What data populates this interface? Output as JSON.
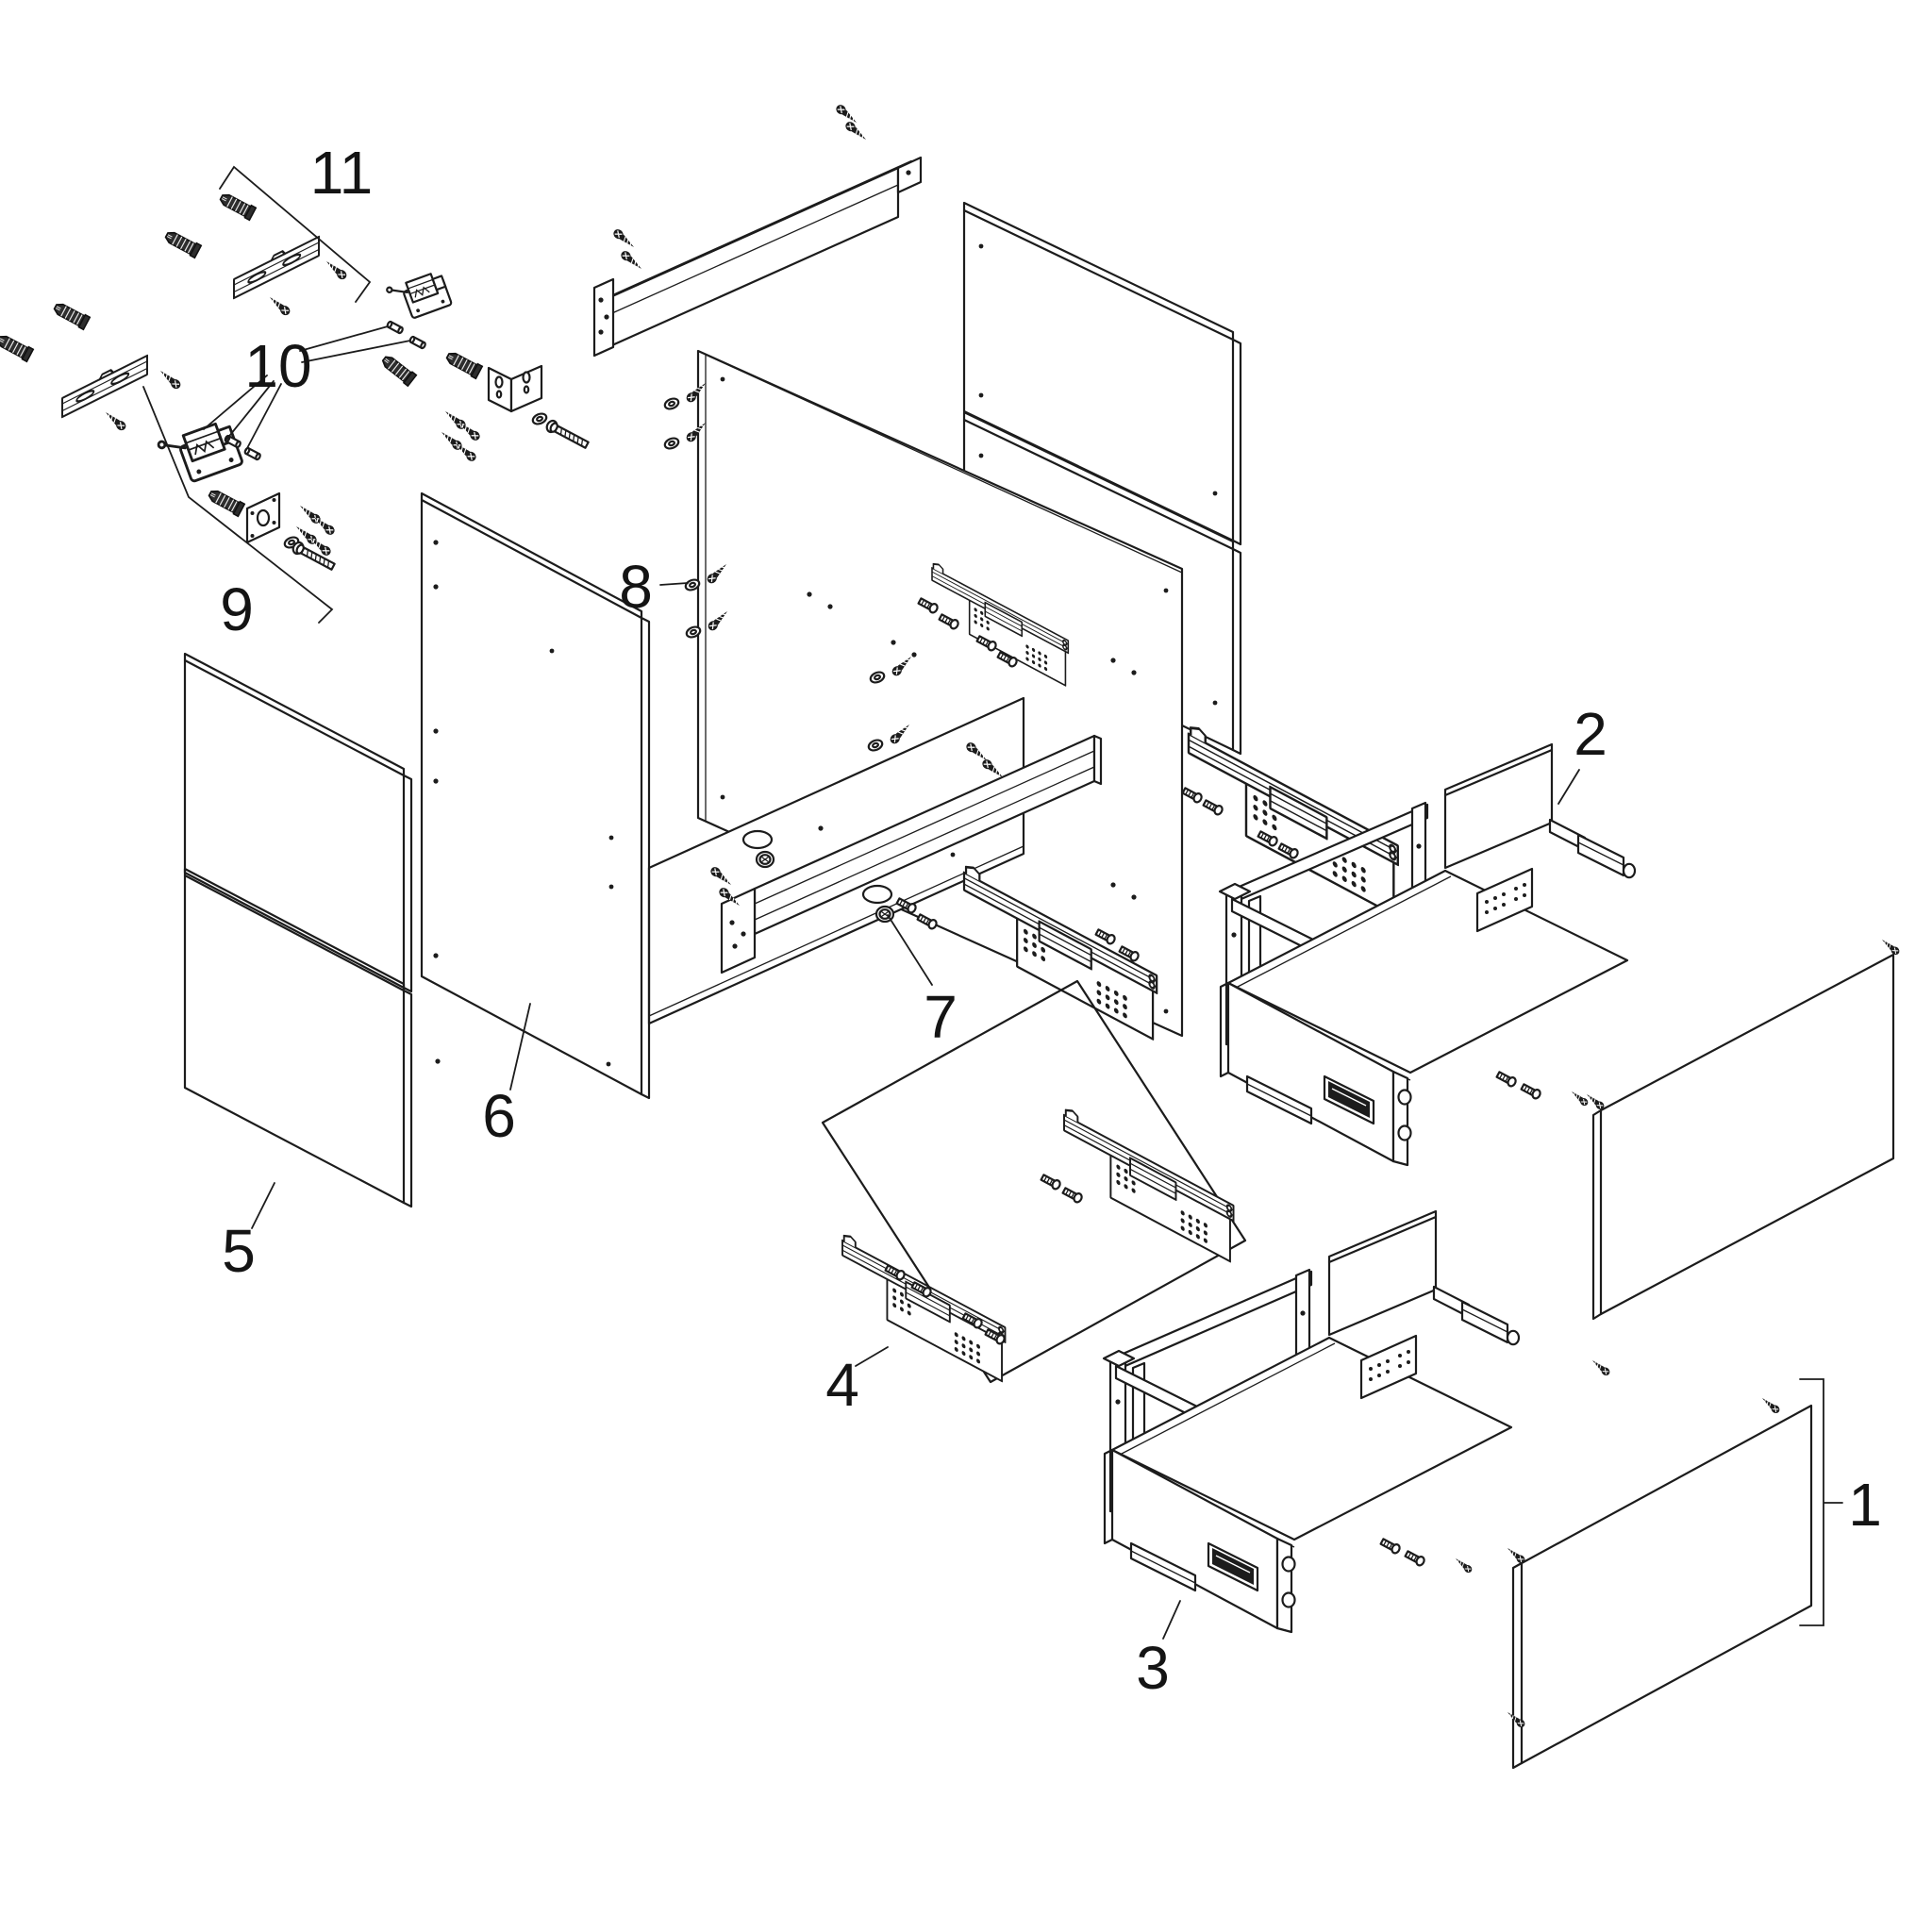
{
  "diagram": {
    "background_color": "#ffffff",
    "line_color": "#1c1c1c",
    "callouts": [
      {
        "label": "1"
      },
      {
        "label": "2"
      },
      {
        "label": "3"
      },
      {
        "label": "4"
      },
      {
        "label": "5"
      },
      {
        "label": "6"
      },
      {
        "label": "7"
      },
      {
        "label": "8"
      },
      {
        "label": "9"
      },
      {
        "label": "10"
      },
      {
        "label": "11"
      }
    ]
  }
}
